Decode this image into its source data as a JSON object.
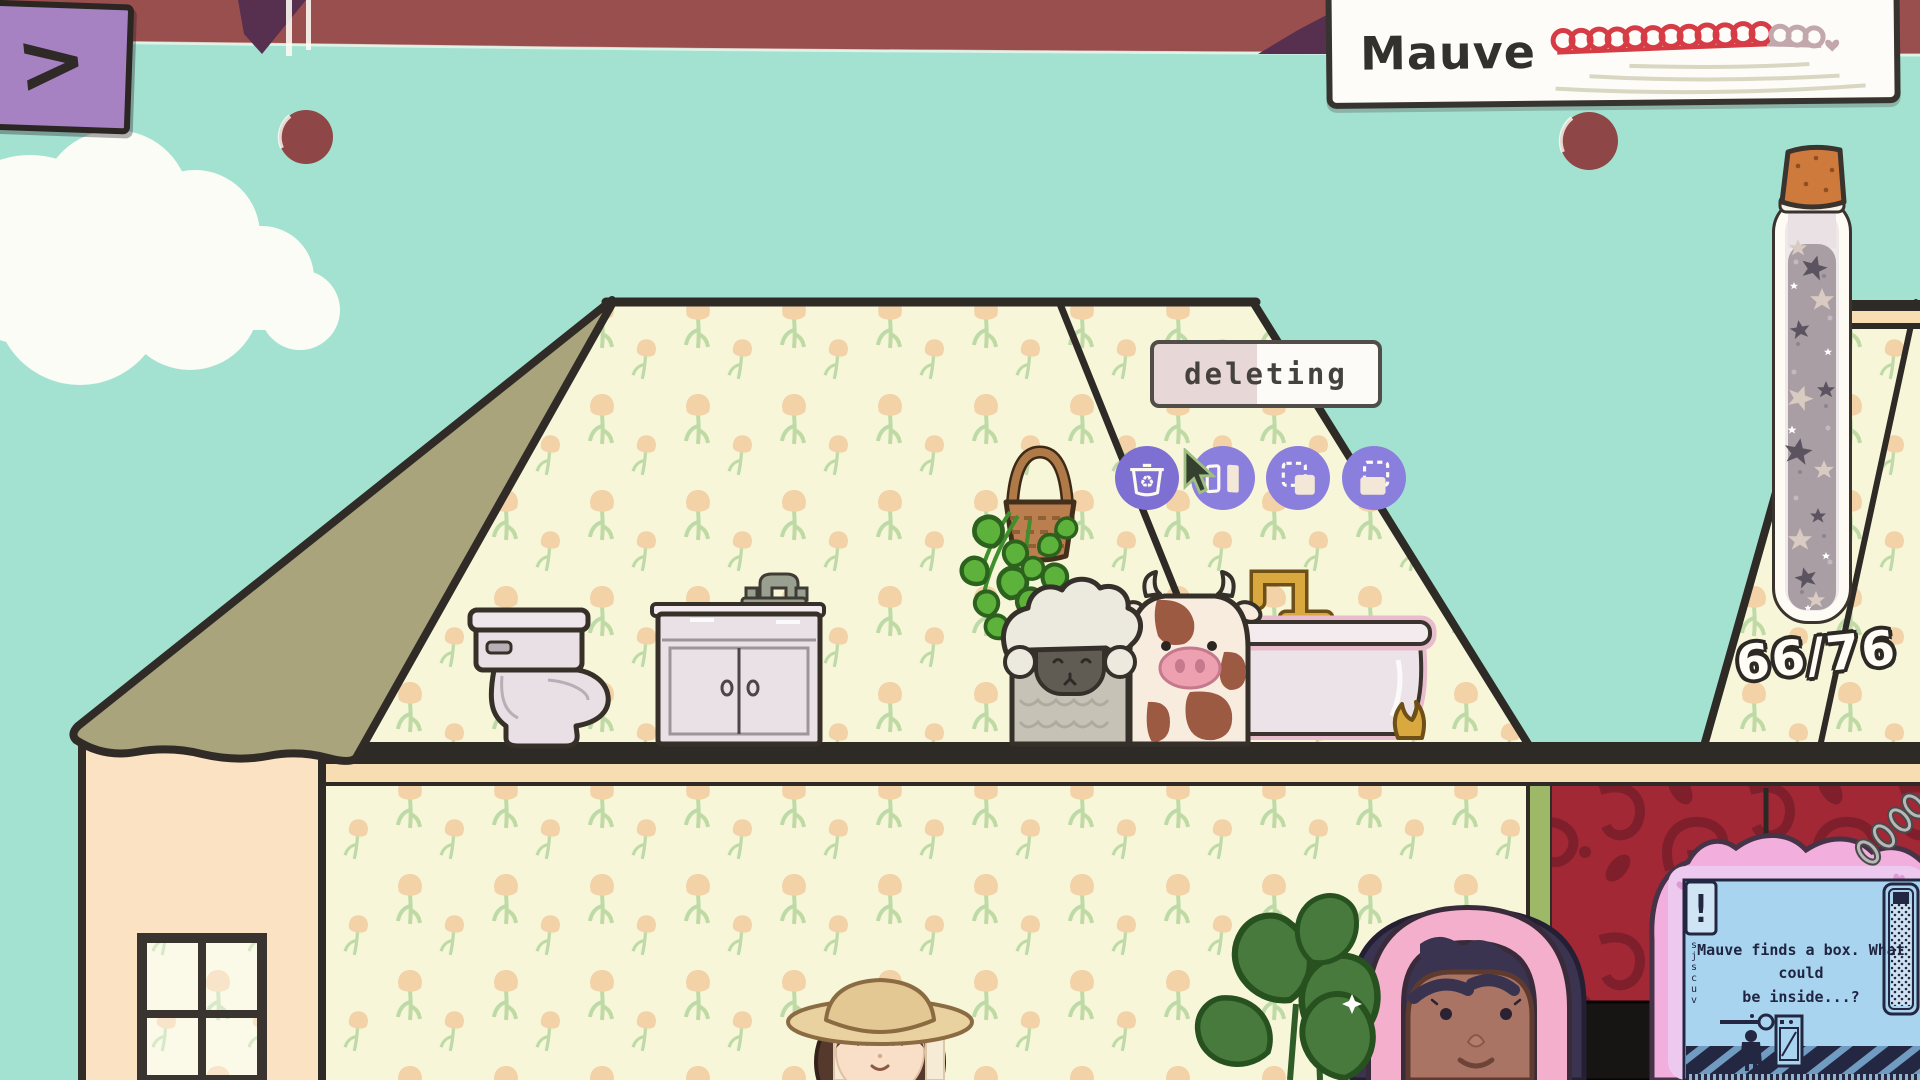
{
  "hud": {
    "back_button_glyph": ">",
    "location_sign": {
      "name": "Mauve",
      "loops_filled": 12,
      "loops_remaining": 3,
      "end_heart": true
    },
    "tooltip_label": "deleting",
    "tools": [
      {
        "id": "delete",
        "icon": "recycle-bin-icon"
      },
      {
        "id": "flip",
        "icon": "mirror-flip-icon"
      },
      {
        "id": "copy",
        "icon": "copy-icon"
      },
      {
        "id": "duplicate",
        "icon": "duplicate-icon"
      }
    ],
    "collection_counter": {
      "current": 66,
      "total": 76,
      "display": "66/76"
    }
  },
  "device": {
    "alert_glyph": "!",
    "dialog_line1": "Mauve finds a box. What could",
    "dialog_line2": "be inside...?",
    "side_marks": [
      "s",
      "j",
      "s",
      "c",
      "u",
      "v"
    ]
  },
  "scene_items": [
    "toilet",
    "sink-vanity",
    "hanging-plant",
    "sheep-plush",
    "cow-plush",
    "bathtub",
    "star-jar",
    "window",
    "monstera-plant",
    "girl-with-hat",
    "mauve-character",
    "handheld-device",
    "chain",
    "cloud",
    "chalk-fruit-left",
    "chalk-fruit-right"
  ],
  "palette": {
    "sky": "#a3e2d1",
    "roof_band": "#9a4f4f",
    "roof_olive": "#a9a47c",
    "wallpaper_cream": "#f8f6d8",
    "tulip": "#f2d2a6",
    "leaf_green": "#bedaa6",
    "wall_peach": "#fbe2c2",
    "floor_dark": "#2e2a26",
    "floor_cream": "#f8ddb2",
    "red_wall": "#a12834",
    "red_wall_motif": "#7f1f2c",
    "button_purple": "#8b7fdd",
    "sign_loop_red": "#d63c45",
    "device_pink": "#f2aedd",
    "device_screen": "#a9d4ef",
    "device_ink": "#232741"
  }
}
